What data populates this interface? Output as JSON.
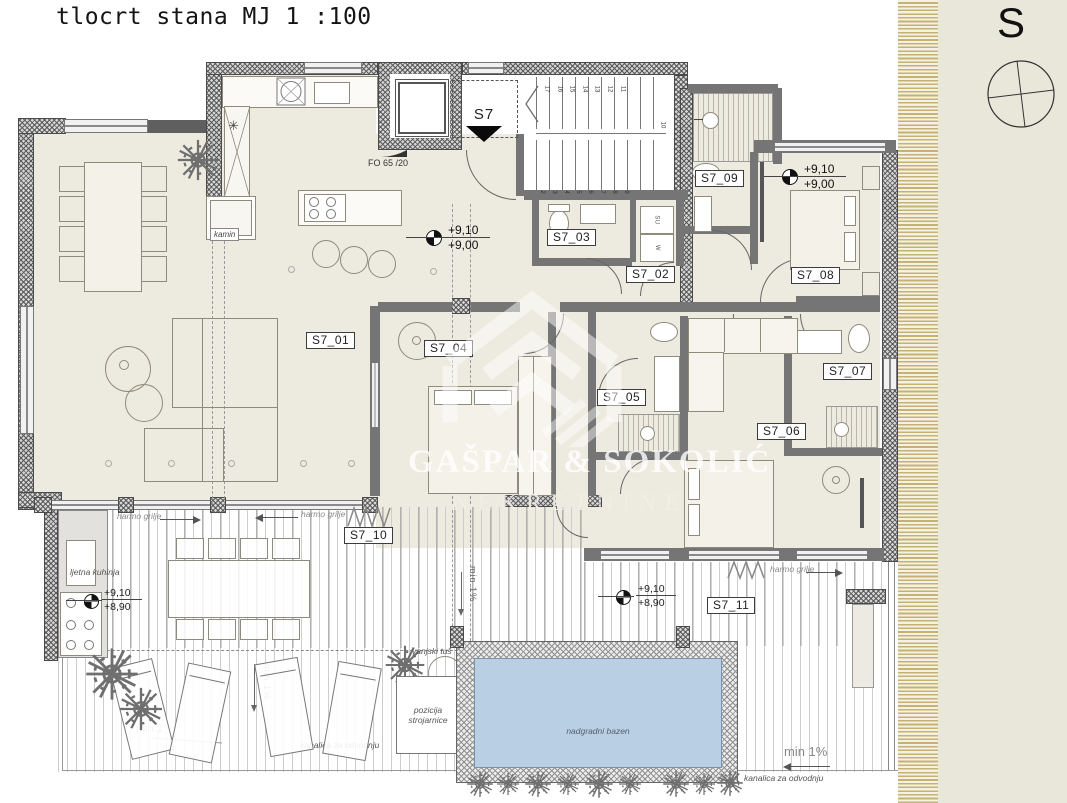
{
  "title": "tlocrt stana MJ 1 :100",
  "compass": {
    "north": "S"
  },
  "unit": {
    "entry": "S7",
    "door_spec": "FO 65 /20"
  },
  "rooms": {
    "r01": "S7_01",
    "r02": "S7_02",
    "r03": "S7_03",
    "r04": "S7_04",
    "r05": "S7_05",
    "r06": "S7_06",
    "r07": "S7_07",
    "r08": "S7_08",
    "r09": "S7_09",
    "r10": "S7_10",
    "r11": "S7_11"
  },
  "elevations": {
    "hall_top": "+9,10",
    "hall_bottom": "+9,00",
    "bed_top": "+9,10",
    "bed_bottom": "+9,00",
    "terrace_left_top": "+9,10",
    "terrace_left_bottom": "+8,90",
    "terrace_right_top": "+9,10",
    "terrace_right_bottom": "+8,90"
  },
  "stairs": {
    "upper": [
      "17",
      "16",
      "15",
      "14",
      "13",
      "12",
      "11"
    ],
    "corner": "10",
    "lower": [
      "2",
      "3",
      "4",
      "5",
      "6",
      "7",
      "8",
      "9"
    ]
  },
  "appliances": {
    "dryer": "SU",
    "washer": "W"
  },
  "annotations": {
    "kamin": "kamin",
    "ljetna_kuhinja": "ljetna kuhinja",
    "harmo_grilje": "harmo grilje",
    "vanjski_tus": "vanjski tuš",
    "pozicija": "pozicija",
    "strojarnice": "strojarnice",
    "min_one": "min 1",
    "min_one_pct": "min 1%",
    "kanalica": "kanalica za odvodnju",
    "bazen": "nadgradni bazen"
  },
  "watermark": {
    "name": "GAŠPAR & SOKOLIĆ",
    "subtitle": "NEKRETNINE"
  },
  "colors": {
    "pool_water": "#b9cfe3",
    "panel": "#e9e6da",
    "hatch_line": "#c3b273",
    "room_fill": "#edeadf"
  }
}
